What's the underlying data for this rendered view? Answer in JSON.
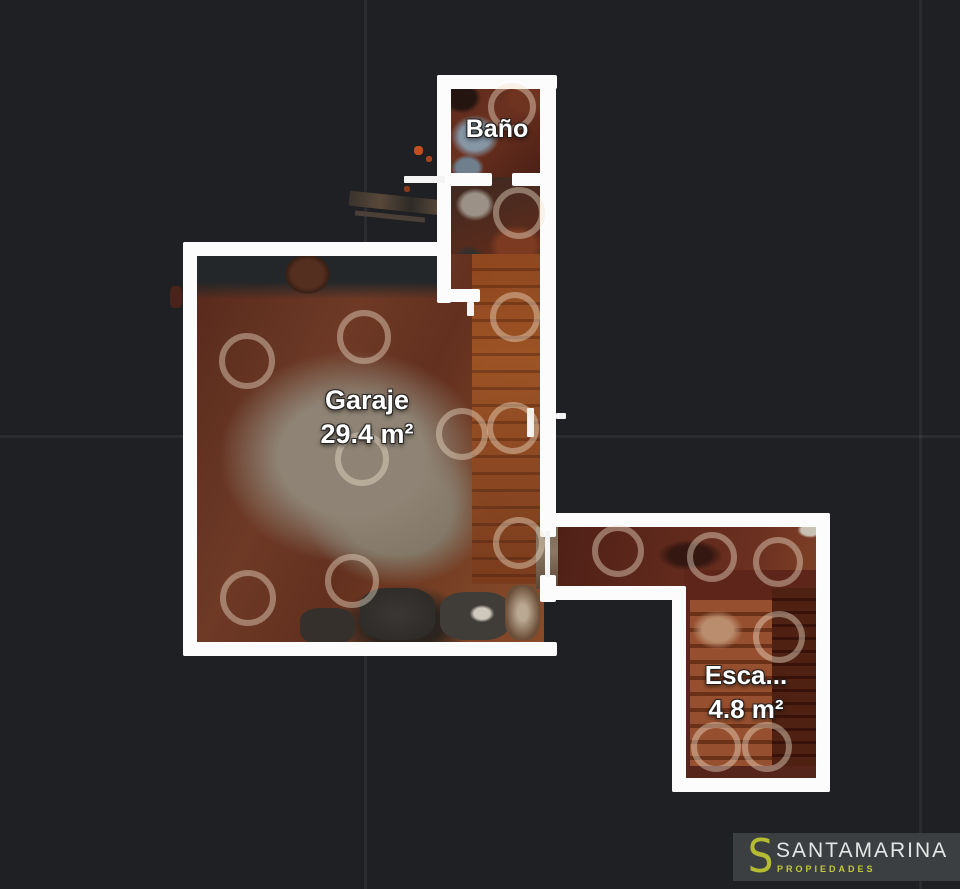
{
  "app": {
    "type": "floorplan-viewer"
  },
  "canvas": {
    "background": "#1f2023",
    "wall_color": "#ffffff"
  },
  "floorplan": {
    "rooms": [
      {
        "id": "bano",
        "label": "Baño"
      },
      {
        "id": "garaje",
        "label": "Garaje",
        "area": "29.4 m²"
      },
      {
        "id": "escalera",
        "label": "Esca...",
        "area": "4.8 m²"
      }
    ],
    "scan_rings": [
      [
        512,
        107,
        24
      ],
      [
        519,
        213,
        26
      ],
      [
        247,
        361,
        28
      ],
      [
        364,
        337,
        27
      ],
      [
        362,
        459,
        27
      ],
      [
        462,
        434,
        26
      ],
      [
        515,
        317,
        25
      ],
      [
        513,
        428,
        26
      ],
      [
        519,
        543,
        26
      ],
      [
        248,
        598,
        28
      ],
      [
        352,
        581,
        27
      ],
      [
        618,
        551,
        26
      ],
      [
        712,
        557,
        25
      ],
      [
        778,
        562,
        25
      ],
      [
        779,
        637,
        26
      ],
      [
        716,
        747,
        25
      ],
      [
        767,
        747,
        25
      ]
    ],
    "ring_color": "rgba(240,226,206,0.42)"
  },
  "watermark": {
    "logo_letter": "S",
    "brand": "SANTAMARINA",
    "tagline": "PROPIEDADES",
    "brand_color": "#e4e6e5",
    "accent_color": "#bdc334",
    "box_color": "#3b3f42"
  }
}
